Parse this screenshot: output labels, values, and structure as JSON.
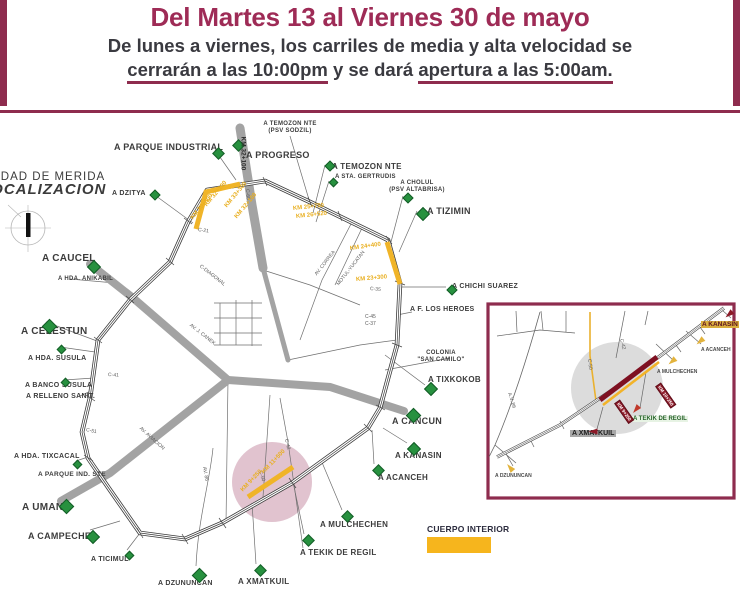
{
  "colors": {
    "maroon": "#8e2c4e",
    "title": "#9e2b56",
    "text_dark": "#3a3a40",
    "yellow": "#f5b517",
    "green_marker": "#27913f",
    "pink_highlight": "#c488a0",
    "road_gray": "#a3a3a3",
    "closure_red": "#7e1021"
  },
  "header": {
    "title": "Del Martes 13 al Viernes 30 de mayo",
    "subtitle_line1": "De lunes a viernes, los carriles de media y alta velocidad se",
    "subtitle_underline1": "cerrarán a las 10:00pm",
    "subtitle_mid": " y se dará ",
    "subtitle_underline2": "apertura a las 5:00am."
  },
  "map": {
    "title_line1": "CIUDAD DE MERIDA",
    "title_line2": "LOCALIZACION",
    "legend_label": "CUERPO INTERIOR",
    "destinations": [
      {
        "text": "A PARQUE INDUSTRIAL",
        "x": 114,
        "y": 142,
        "s": 9
      },
      {
        "text": "A PROGRESO",
        "x": 246,
        "y": 150,
        "s": 9
      },
      {
        "text": "A TEMOZON NTE",
        "x": 290,
        "y": 121,
        "s": 6,
        "align": "center"
      },
      {
        "text": "(PSV SODZIL)",
        "x": 290,
        "y": 128,
        "s": 6,
        "align": "center"
      },
      {
        "text": "A TEMOZON NTE",
        "x": 332,
        "y": 162,
        "s": 8
      },
      {
        "text": "A STA. GERTRUDIS",
        "x": 335,
        "y": 174,
        "s": 6
      },
      {
        "text": "A CHOLUL",
        "x": 417,
        "y": 180,
        "s": 6,
        "align": "center"
      },
      {
        "text": "(PSV ALTABRISA)",
        "x": 417,
        "y": 187,
        "s": 6,
        "align": "center"
      },
      {
        "text": "A TIZIMIN",
        "x": 427,
        "y": 206,
        "s": 9
      },
      {
        "text": "A DZITYA",
        "x": 112,
        "y": 190,
        "s": 7
      },
      {
        "text": "A CAUCEL",
        "x": 42,
        "y": 253,
        "s": 10
      },
      {
        "text": "A HDA. ANIKABIL",
        "x": 58,
        "y": 276,
        "s": 6
      },
      {
        "text": "A CHICHI SUAREZ",
        "x": 452,
        "y": 283,
        "s": 7
      },
      {
        "text": "A F. LOS HEROES",
        "x": 410,
        "y": 306,
        "s": 7
      },
      {
        "text": "A CELESTUN",
        "x": 21,
        "y": 326,
        "s": 10
      },
      {
        "text": "A HDA. SUSULA",
        "x": 28,
        "y": 355,
        "s": 7
      },
      {
        "text": "A BANCO SUSULA",
        "x": 25,
        "y": 382,
        "s": 7
      },
      {
        "text": "A RELLENO SANIT.",
        "x": 26,
        "y": 393,
        "s": 7
      },
      {
        "text": "COLONIA",
        "x": 441,
        "y": 350,
        "s": 6,
        "align": "center"
      },
      {
        "text": "\"SAN CAMILO\"",
        "x": 441,
        "y": 357,
        "s": 6,
        "align": "center"
      },
      {
        "text": "A TIXKOKOB",
        "x": 428,
        "y": 375,
        "s": 8
      },
      {
        "text": "A CANCUN",
        "x": 392,
        "y": 416,
        "s": 9
      },
      {
        "text": "A KANASIN",
        "x": 395,
        "y": 451,
        "s": 8
      },
      {
        "text": "A ACANCEH",
        "x": 378,
        "y": 473,
        "s": 8
      },
      {
        "text": "A HDA. TIXCACAL",
        "x": 14,
        "y": 453,
        "s": 7
      },
      {
        "text": "A PARQUE IND. STE",
        "x": 38,
        "y": 471,
        "s": 6.5
      },
      {
        "text": "A UMAN",
        "x": 22,
        "y": 502,
        "s": 10
      },
      {
        "text": "A CAMPECHE",
        "x": 28,
        "y": 531,
        "s": 9
      },
      {
        "text": "A TICIMUL",
        "x": 91,
        "y": 556,
        "s": 7
      },
      {
        "text": "A MULCHECHEN",
        "x": 320,
        "y": 520,
        "s": 8
      },
      {
        "text": "A TEKIK DE REGIL",
        "x": 300,
        "y": 548,
        "s": 8
      },
      {
        "text": "A XMATKUIL",
        "x": 238,
        "y": 577,
        "s": 8
      },
      {
        "text": "A DZUNUNCAN",
        "x": 158,
        "y": 580,
        "s": 7
      }
    ],
    "markers": [
      {
        "x": 214,
        "y": 149,
        "s": 7
      },
      {
        "x": 234,
        "y": 141,
        "s": 7
      },
      {
        "x": 151,
        "y": 191,
        "s": 6
      },
      {
        "x": 326,
        "y": 162,
        "s": 6
      },
      {
        "x": 330,
        "y": 179,
        "s": 5
      },
      {
        "x": 404,
        "y": 194,
        "s": 6
      },
      {
        "x": 418,
        "y": 209,
        "s": 8
      },
      {
        "x": 89,
        "y": 262,
        "s": 8
      },
      {
        "x": 448,
        "y": 286,
        "s": 6
      },
      {
        "x": 44,
        "y": 321,
        "s": 9
      },
      {
        "x": 58,
        "y": 346,
        "s": 5
      },
      {
        "x": 62,
        "y": 379,
        "s": 5
      },
      {
        "x": 426,
        "y": 384,
        "s": 8
      },
      {
        "x": 408,
        "y": 410,
        "s": 9
      },
      {
        "x": 409,
        "y": 444,
        "s": 8
      },
      {
        "x": 374,
        "y": 466,
        "s": 7
      },
      {
        "x": 74,
        "y": 461,
        "s": 5
      },
      {
        "x": 61,
        "y": 501,
        "s": 9
      },
      {
        "x": 88,
        "y": 532,
        "s": 8
      },
      {
        "x": 126,
        "y": 552,
        "s": 5
      },
      {
        "x": 343,
        "y": 512,
        "s": 7
      },
      {
        "x": 304,
        "y": 536,
        "s": 7
      },
      {
        "x": 256,
        "y": 566,
        "s": 7
      },
      {
        "x": 194,
        "y": 570,
        "s": 9
      }
    ],
    "road_labels": [
      {
        "text": "C-21",
        "x": 198,
        "y": 227,
        "r": 8
      },
      {
        "text": "C-DIAGONAL",
        "x": 200,
        "y": 263,
        "r": 38
      },
      {
        "text": "AV. J. CANEK",
        "x": 190,
        "y": 322,
        "r": 38
      },
      {
        "text": "C-41",
        "x": 108,
        "y": 372,
        "r": 4
      },
      {
        "text": "C-51",
        "x": 86,
        "y": 427,
        "r": 12
      },
      {
        "text": "AV. AVIACION",
        "x": 140,
        "y": 425,
        "r": 42
      },
      {
        "text": "AV. 86",
        "x": 204,
        "y": 464,
        "r": 80
      },
      {
        "text": "C-35",
        "x": 370,
        "y": 286,
        "r": 5
      },
      {
        "text": "C-45",
        "x": 365,
        "y": 314,
        "r": 0
      },
      {
        "text": "C-37",
        "x": 365,
        "y": 321,
        "r": 0
      },
      {
        "text": "C-42",
        "x": 286,
        "y": 436,
        "r": 78
      },
      {
        "text": "C-50",
        "x": 260,
        "y": 468,
        "r": 72
      },
      {
        "text": "C-60",
        "x": 247,
        "y": 186,
        "r": 86
      },
      {
        "text": "AV. CORREA",
        "x": 316,
        "y": 272,
        "r": -52
      },
      {
        "text": "MOTUL-YUCATAN",
        "x": 338,
        "y": 282,
        "r": -52
      }
    ],
    "km_labels": [
      {
        "text": "KM 30+300",
        "x": 192,
        "y": 216,
        "r": -50,
        "c": "y"
      },
      {
        "text": "KM 32+100",
        "x": 206,
        "y": 203,
        "r": -50,
        "c": "y"
      },
      {
        "text": "KM 33+300",
        "x": 226,
        "y": 204,
        "r": -50,
        "c": "y"
      },
      {
        "text": "KM 32+100",
        "x": 236,
        "y": 215,
        "r": -50,
        "c": "y"
      },
      {
        "text": "KM 32+100",
        "x": 243,
        "y": 133,
        "r": 90,
        "c": "k"
      },
      {
        "text": "KM 25+750",
        "x": 293,
        "y": 206,
        "r": -6,
        "c": "y"
      },
      {
        "text": "KM 26+520",
        "x": 296,
        "y": 214,
        "r": -6,
        "c": "y"
      },
      {
        "text": "KM 24+400",
        "x": 350,
        "y": 246,
        "r": -8,
        "c": "y"
      },
      {
        "text": "KM 23+300",
        "x": 356,
        "y": 277,
        "r": -5,
        "c": "y"
      },
      {
        "text": "KM 11+500",
        "x": 263,
        "y": 470,
        "r": -46,
        "c": "y"
      },
      {
        "text": "KM 9+250",
        "x": 242,
        "y": 488,
        "r": -46,
        "c": "y"
      }
    ]
  },
  "inset": {
    "labels": [
      {
        "text": "A KANASIN",
        "x": 701,
        "y": 321,
        "cls": "hl-yellow"
      },
      {
        "text": "A ACANCEH",
        "x": 701,
        "y": 347,
        "cls": "tiny"
      },
      {
        "text": "A MULCHECHEN",
        "x": 657,
        "y": 369,
        "cls": "tiny"
      },
      {
        "text": "A TEKIK DE REGIL",
        "x": 632,
        "y": 416,
        "cls": "hl-green"
      },
      {
        "text": "A XMATKUIL",
        "x": 570,
        "y": 430,
        "cls": "hl-gray"
      },
      {
        "text": "A DZUNUNCAN",
        "x": 495,
        "y": 473,
        "cls": "tiny"
      }
    ],
    "km_labels": [
      {
        "text": "KM 10+250",
        "x": 658,
        "y": 381,
        "r": 55
      },
      {
        "text": "KM 9+250",
        "x": 617,
        "y": 398,
        "r": 55
      }
    ],
    "road_labels": [
      {
        "text": "C-42",
        "x": 621,
        "y": 336,
        "r": 75
      },
      {
        "text": "C-50",
        "x": 589,
        "y": 356,
        "r": 83
      },
      {
        "text": "A.V. 86",
        "x": 509,
        "y": 390,
        "r": 72
      }
    ],
    "arrows": [
      {
        "x": 726,
        "y": 310,
        "c": "#8c1a28",
        "r": -130
      },
      {
        "x": 697,
        "y": 337,
        "c": "#e3b33c",
        "r": -130
      },
      {
        "x": 669,
        "y": 357,
        "c": "#e3b33c",
        "r": -130
      },
      {
        "x": 633,
        "y": 405,
        "c": "#c0392b",
        "r": -140
      },
      {
        "x": 590,
        "y": 427,
        "c": "#8c1a28",
        "r": -90
      },
      {
        "x": 507,
        "y": 463,
        "c": "#e3b33c",
        "r": -40
      }
    ]
  }
}
